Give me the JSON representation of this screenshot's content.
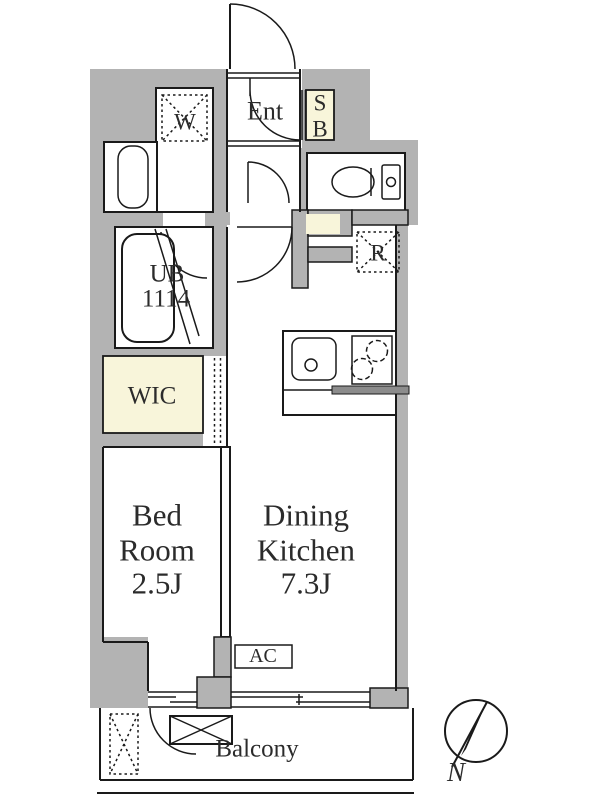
{
  "floor_plan": {
    "entrance": {
      "label": "Ent"
    },
    "shoe_box": {
      "top": "S",
      "bottom": "B"
    },
    "washing_machine": {
      "label": "W"
    },
    "unit_bath": {
      "name": "UB",
      "size": "1114"
    },
    "refrigerator": {
      "label": "R"
    },
    "walk_in_closet": {
      "label": "WIC"
    },
    "bedroom": {
      "name_line1": "Bed",
      "name_line2": "Room",
      "size": "2.5J"
    },
    "dining_kitchen": {
      "name_line1": "Dining",
      "name_line2": "Kitchen",
      "size": "7.3J"
    },
    "air_conditioner": {
      "label": "AC"
    },
    "balcony": {
      "label": "Balcony"
    },
    "compass": {
      "north": "N"
    }
  },
  "colors": {
    "wall": "#b3b3b3",
    "accent": "#f8f5da",
    "line": "#1a1a1a",
    "text": "#2b2b2b"
  }
}
